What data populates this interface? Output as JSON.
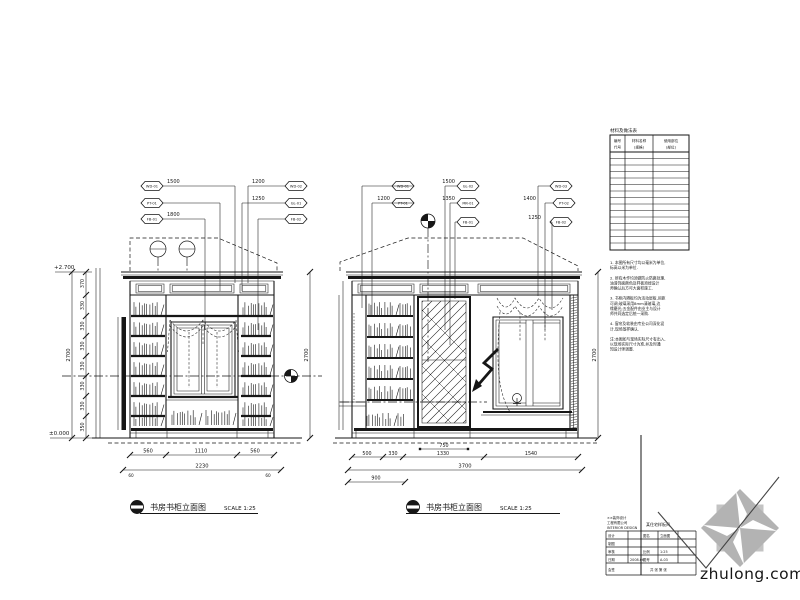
{
  "sheet": {
    "background": "#ffffff",
    "ink": "#161616",
    "watermark_color": "#c4c4c4"
  },
  "elevation_left": {
    "title": "书房书柜立面图",
    "scale": "SCALE 1:25",
    "level_top": "+2.700",
    "level_bottom": "±0.000",
    "tags": [
      {
        "code": "WD-01",
        "dim": "1500"
      },
      {
        "code": "PT-01",
        "dim": ""
      },
      {
        "code": "FB-01",
        "dim": "1800"
      },
      {
        "code": "WD-02",
        "dim": "1200"
      },
      {
        "code": "GL-01",
        "dim": "1250"
      },
      {
        "code": "FB-02",
        "dim": ""
      }
    ],
    "dims_bottom": [
      "560",
      "1110",
      "560"
    ],
    "dim_total_bottom": "2230",
    "edge_left": "60",
    "edge_right": "60",
    "dims_side": [
      "370",
      "330",
      "330",
      "330",
      "330",
      "330",
      "330",
      "350"
    ],
    "dim_total_side": "2700",
    "dim_total_right": "2700"
  },
  "elevation_right": {
    "title": "书房书柜立面图",
    "scale": "SCALE 1:25",
    "tags": [
      {
        "code": "WD-01",
        "dim": ""
      },
      {
        "code": "PT-01",
        "dim": "1200"
      },
      {
        "code": "GL-02",
        "dim": "1500"
      },
      {
        "code": "MR-01",
        "dim": "1350"
      },
      {
        "code": "FB-01",
        "dim": ""
      },
      {
        "code": "WD-03",
        "dim": ""
      },
      {
        "code": "PT-02",
        "dim": "1400"
      },
      {
        "code": "FB-02",
        "dim": "1250"
      }
    ],
    "dims_bottom": [
      "500",
      "330",
      "1330",
      "1540"
    ],
    "dim_inner": "750",
    "dim_total_bottom": "3700",
    "dim_extra": "900",
    "dim_total_side": "2700"
  },
  "schedule": {
    "caption": "材料及做法表",
    "headers": [
      "编号",
      "材料名称",
      "使用部位"
    ],
    "subheaders": [
      "代号",
      "(规格)",
      "(部位)"
    ]
  },
  "notes": {
    "lines": [
      "1. 本图所有尺寸均以毫米为单位,",
      "   标高以米为单位.",
      "",
      "2. 所有木作均须做防火防腐处理,",
      "   油漆饰面颜色及样板须经设计",
      "   师确认后方可大面积施工.",
      "",
      "3. 书柜内隔板均为活动层板,间距",
      "   可调;玻璃采用8mm清玻璃,边",
      "   缘磨光;五金配件由业主与设计",
      "   师共同选定后统一采购.",
      "",
      "4. 窗帘及软装由专业公司深化设",
      "   计,现场放样确认.",
      "",
      "注:本图如与现场实际尺寸有出入,",
      "   以现场实际尺寸为准,并及时通",
      "   知设计师调整."
    ]
  },
  "titleblock": {
    "company_lines": [
      "××装饰设计",
      "工程有限公司",
      "INTERIOR DESIGN"
    ],
    "project": "某住宅样板间",
    "rows": [
      {
        "label": "设计",
        "value": "",
        "label2": "图名",
        "value2": "立面图"
      },
      {
        "label": "制图",
        "value": "",
        "label2": "",
        "value2": ""
      },
      {
        "label": "审核",
        "value": "",
        "label2": "比例",
        "value2": "1:25"
      },
      {
        "label": "日期",
        "value": "2008.06",
        "label2": "图号",
        "value2": "A-03"
      }
    ],
    "footer_left": "会签",
    "footer_right": "共 张 第 张"
  },
  "watermark": {
    "text": "zhulong.com"
  }
}
